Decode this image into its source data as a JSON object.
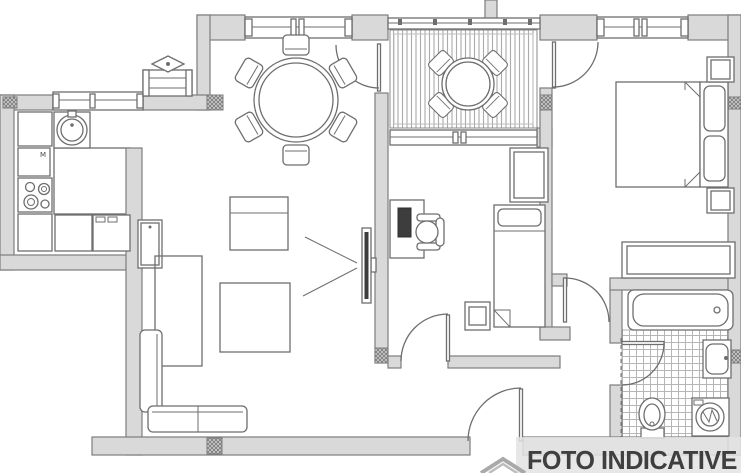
{
  "watermark": {
    "label": "FOTO INDICATIVE",
    "icon": "roof-logo-icon"
  },
  "kitchen_mark": "M",
  "plan_icons": [
    "kitchen-sink-icon",
    "stove-burners-icon",
    "kitchen-tile-floor",
    "radiator-icon",
    "round-dining-table-icon",
    "dining-chair-icon",
    "balcony-deck",
    "balcony-table-icon",
    "tv-icon",
    "tv-stand-icon",
    "striped-chest-icon",
    "rug-icon",
    "sofa-icon",
    "tall-cabinet-icon",
    "desk-icon",
    "monitor-icon",
    "office-chair-icon",
    "single-bed-icon",
    "stool-icon",
    "wardrobe-icon",
    "double-bed-icon",
    "pillow-icon",
    "nightstand-icon",
    "bathtub-icon",
    "washbasin-icon",
    "toilet-icon",
    "washing-machine-icon",
    "door-swing-icon",
    "window-icon",
    "wall-section-hatch"
  ],
  "colors": {
    "background": "#ffffff",
    "wall_fill": "#d9d9d9",
    "wall_edge": "#7d7d7d",
    "line": "#6e6e6e",
    "line_dark": "#4a4a4a",
    "pattern": "#9a9a9a",
    "tile": "#b6b6b6",
    "deck_stripe": "#ababab",
    "monitor_fill": "#3d3d3d",
    "watermark_text": "#3f3f3f",
    "watermark_bg": "#e3e3e3",
    "logo": "#a9a9a9"
  }
}
